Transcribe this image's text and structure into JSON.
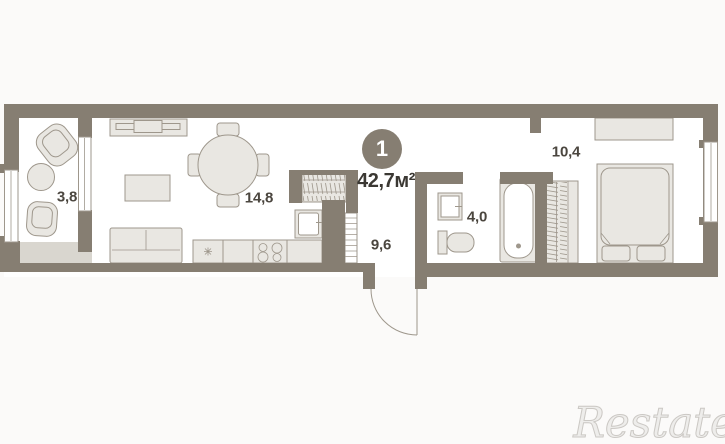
{
  "plan": {
    "unit_badge": "1",
    "total_area": "42,7м²",
    "rooms": {
      "balcony": "3,8",
      "living": "14,8",
      "hallway": "9,6",
      "bathroom": "4,0",
      "bedroom": "10,4"
    }
  },
  "watermark": "Restate",
  "colors": {
    "wall": "#867e72",
    "floor": "#ffffff",
    "bg": "#fbfaf9",
    "furn_fill": "#e9e7e2",
    "furn_stroke": "#9e978c",
    "terrace": "#d9d6cf",
    "label": "#4b463f",
    "area_text": "#3b3833",
    "watermark": "#eeedeb",
    "watermark_stroke": "#cbc8c4",
    "badge_text": "#ffffff"
  }
}
